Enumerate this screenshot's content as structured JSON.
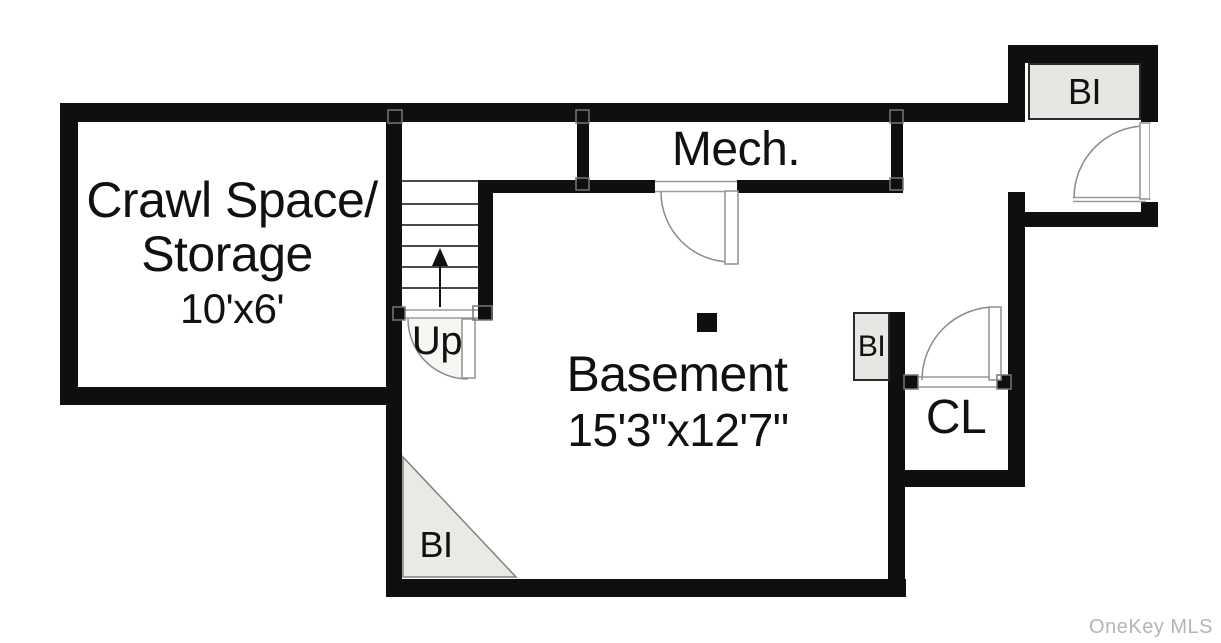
{
  "floorplan": {
    "rooms": {
      "crawl_space": {
        "name_line1": "Crawl Space/",
        "name_line2": "Storage",
        "dimensions": "10'x6'"
      },
      "mechanical": {
        "name": "Mech."
      },
      "basement": {
        "name": "Basement",
        "dimensions": "15'3\"x12'7\""
      },
      "closet": {
        "name": "CL"
      }
    },
    "stairs": {
      "direction_label": "Up"
    },
    "built_ins": {
      "top_right": {
        "label": "BI"
      },
      "middle_right": {
        "label": "BI"
      },
      "bottom_left": {
        "label": "BI"
      }
    },
    "watermark": {
      "text": "OneKey MLS",
      "color": "#b5b5b5"
    },
    "colors": {
      "background": "#ffffff",
      "wall": "#0f0f0f",
      "built_in_fill": "#e6e6e3",
      "built_in_border": "#2a2a2a",
      "door_line": "#909090",
      "stair_tread": "#4a4a4a",
      "text": "#111111"
    }
  }
}
